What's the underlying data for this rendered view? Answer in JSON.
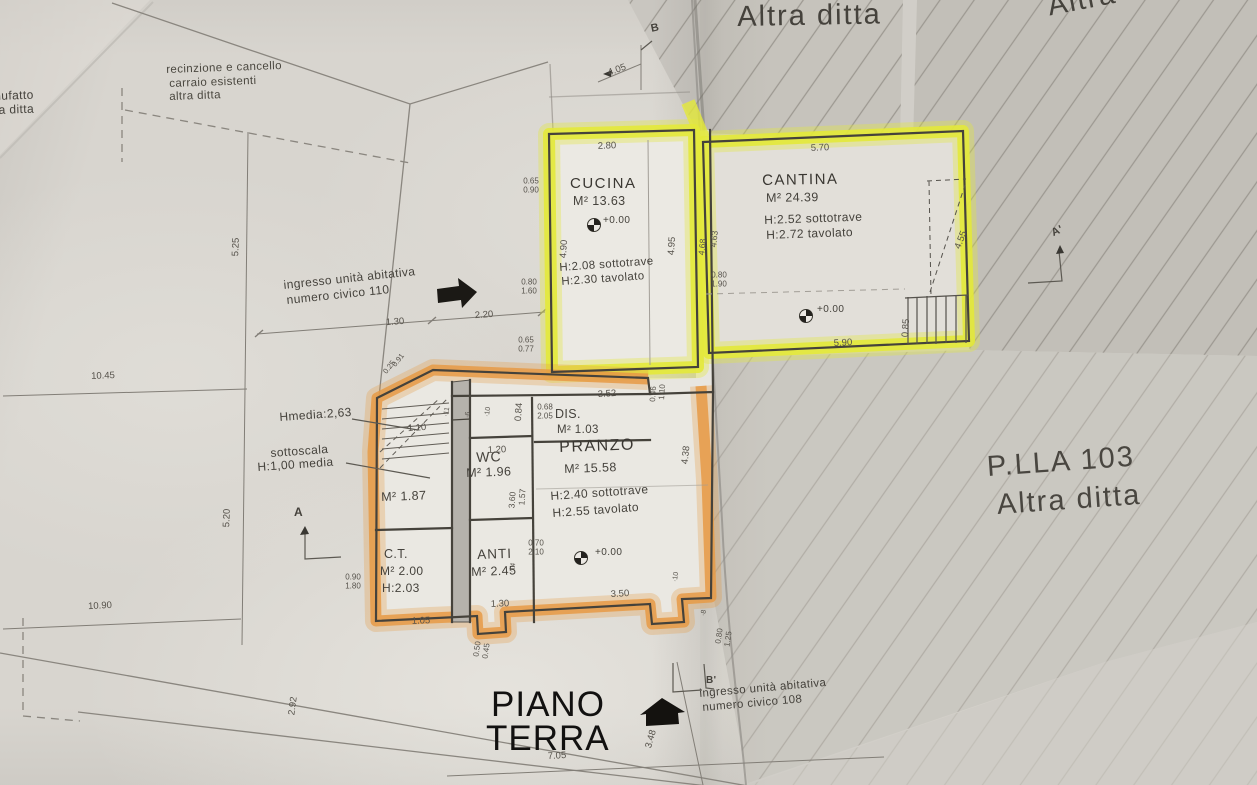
{
  "title": {
    "line1": "PIANO",
    "line2": "TERRA"
  },
  "rooms": {
    "cucina": {
      "name": "CUCINA",
      "area": "M² 13.63",
      "level": "+0.00",
      "h_sottotrave": "H:2.08 sottotrave",
      "h_tavolato": "H:2.30 tavolato"
    },
    "cantina": {
      "name": "CANTINA",
      "area": "M² 24.39",
      "level": "+0.00",
      "h_sottotrave": "H:2.52 sottotrave",
      "h_tavolato": "H:2.72 tavolato"
    },
    "dis": {
      "name": "DIS.",
      "area": "M² 1.03"
    },
    "pranzo": {
      "name": "PRANZO",
      "area": "M² 15.58",
      "level": "+0.00",
      "h_sottotrave": "H:2.40 sottotrave",
      "h_tavolato": "H:2.55 tavolato"
    },
    "wc": {
      "name": "WC",
      "area": "M² 1.96"
    },
    "anti": {
      "name": "ANTI",
      "area": "M² 2.45"
    },
    "ct": {
      "name": "C.T.",
      "area": "M² 2.00",
      "height": "H:2.03"
    },
    "understair": {
      "area": "M² 1.87"
    }
  },
  "annotations": {
    "parcel_top_center": "Altra ditta",
    "parcel_top_right": "Altra ditta",
    "parcel_right": {
      "line1": "P.LLA 103",
      "line2": "Altra ditta"
    },
    "edge_left": {
      "line1": "nufatto",
      "line2": "ra ditta"
    },
    "fence": {
      "line1": "recinzione e cancello",
      "line2": "carraio esistenti",
      "line3": "altra ditta"
    },
    "entrance_110": {
      "line1": "ingresso unità abitativa",
      "line2": "numero civico 110"
    },
    "entrance_108": {
      "line1": "ingresso unità abitativa",
      "line2": "numero civico 108"
    },
    "hmedia": "Hmedia:2,63",
    "sottoscala": {
      "line1": "sottoscala",
      "line2": "H:1,00 media"
    }
  },
  "markers": {
    "a": "A",
    "a_prime": "A'",
    "b": "B",
    "b_prime": "B'"
  },
  "colors": {
    "highlight_yellow": "#e3e93a",
    "highlight_orange": "#e69a45",
    "paper": "#d8d5cf",
    "hatch_fill": "#c7c4be",
    "ink": "#45423b"
  },
  "dimensions": [
    {
      "t": "4.05",
      "x": 617,
      "y": 70,
      "r": -20
    },
    {
      "t": "2.80",
      "x": 607,
      "y": 146,
      "r": -2
    },
    {
      "t": "5.70",
      "x": 820,
      "y": 148,
      "r": -2
    },
    {
      "t": "0.65",
      "x": 531,
      "y": 181,
      "r": 0,
      "s": 8
    },
    {
      "t": "0.90",
      "x": 531,
      "y": 190,
      "r": 0,
      "s": 8
    },
    {
      "t": "4.90",
      "x": 564,
      "y": 249,
      "r": -86
    },
    {
      "t": "4.95",
      "x": 672,
      "y": 246,
      "r": -86
    },
    {
      "t": "4.68",
      "x": 702,
      "y": 247,
      "r": -84,
      "s": 8.5
    },
    {
      "t": "4.63",
      "x": 714,
      "y": 239,
      "r": -84,
      "s": 8.5
    },
    {
      "t": "0.80",
      "x": 719,
      "y": 275,
      "r": 0,
      "s": 8
    },
    {
      "t": "1.90",
      "x": 719,
      "y": 284,
      "r": 0,
      "s": 8
    },
    {
      "t": "0.80",
      "x": 529,
      "y": 282,
      "r": 0,
      "s": 8
    },
    {
      "t": "1.60",
      "x": 529,
      "y": 291,
      "r": 0,
      "s": 8
    },
    {
      "t": "0.65",
      "x": 526,
      "y": 340,
      "r": 0,
      "s": 8
    },
    {
      "t": "0.77",
      "x": 526,
      "y": 349,
      "r": 0,
      "s": 8
    },
    {
      "t": "4.55",
      "x": 961,
      "y": 240,
      "r": -68
    },
    {
      "t": "0.85",
      "x": 906,
      "y": 328,
      "r": -86
    },
    {
      "t": "5.90",
      "x": 843,
      "y": 343,
      "r": -3
    },
    {
      "t": "1.30",
      "x": 395,
      "y": 322,
      "r": -4
    },
    {
      "t": "2.20",
      "x": 484,
      "y": 315,
      "r": -4
    },
    {
      "t": "10.45",
      "x": 103,
      "y": 376,
      "r": -2
    },
    {
      "t": "5.25",
      "x": 236,
      "y": 247,
      "r": -88
    },
    {
      "t": "5.20",
      "x": 227,
      "y": 518,
      "r": -88
    },
    {
      "t": "10.90",
      "x": 100,
      "y": 606,
      "r": -3
    },
    {
      "t": "3.52",
      "x": 607,
      "y": 394,
      "r": -4
    },
    {
      "t": "0.46",
      "x": 653,
      "y": 394,
      "r": -86,
      "s": 8
    },
    {
      "t": "1.10",
      "x": 662,
      "y": 392,
      "r": -86,
      "s": 8
    },
    {
      "t": "0.68",
      "x": 545,
      "y": 407,
      "r": 0,
      "s": 8
    },
    {
      "t": "2.05",
      "x": 545,
      "y": 416,
      "r": 0,
      "s": 8
    },
    {
      "t": "0.84",
      "x": 519,
      "y": 412,
      "r": -86
    },
    {
      "t": "1.10",
      "x": 417,
      "y": 428,
      "r": -4
    },
    {
      "t": "1.20",
      "x": 497,
      "y": 450,
      "r": -2
    },
    {
      "t": "·11",
      "x": 447,
      "y": 412,
      "r": -80,
      "s": 7
    },
    {
      "t": "·6",
      "x": 468,
      "y": 415,
      "r": -80,
      "s": 7
    },
    {
      "t": "·10",
      "x": 488,
      "y": 412,
      "r": -80,
      "s": 7
    },
    {
      "t": "4.38",
      "x": 686,
      "y": 455,
      "r": -84
    },
    {
      "t": "3.60",
      "x": 512,
      "y": 500,
      "r": -86,
      "s": 8.5
    },
    {
      "t": "1.57",
      "x": 522,
      "y": 497,
      "r": -86,
      "s": 8.5
    },
    {
      "t": "0.70",
      "x": 536,
      "y": 543,
      "r": 0,
      "s": 8
    },
    {
      "t": "2.10",
      "x": 536,
      "y": 552,
      "r": 0,
      "s": 8
    },
    {
      "t": "·14",
      "x": 513,
      "y": 568,
      "r": -80,
      "s": 7
    },
    {
      "t": "·10",
      "x": 676,
      "y": 577,
      "r": -80,
      "s": 7
    },
    {
      "t": "3.50",
      "x": 620,
      "y": 594,
      "r": -3
    },
    {
      "t": "1.30",
      "x": 500,
      "y": 604,
      "r": -2
    },
    {
      "t": "1.05",
      "x": 421,
      "y": 621,
      "r": -2
    },
    {
      "t": "0.90",
      "x": 353,
      "y": 577,
      "r": 0,
      "s": 8
    },
    {
      "t": "1.80",
      "x": 353,
      "y": 586,
      "r": 0,
      "s": 8
    },
    {
      "t": "0.50",
      "x": 477,
      "y": 649,
      "r": -82,
      "s": 8
    },
    {
      "t": "0.45",
      "x": 486,
      "y": 651,
      "r": -82,
      "s": 8
    },
    {
      "t": "·8",
      "x": 704,
      "y": 613,
      "r": -80,
      "s": 7
    },
    {
      "t": "0.80",
      "x": 719,
      "y": 636,
      "r": -82,
      "s": 8
    },
    {
      "t": "1.25",
      "x": 728,
      "y": 639,
      "r": -82,
      "s": 8
    },
    {
      "t": "7.05",
      "x": 557,
      "y": 756,
      "r": -3
    },
    {
      "t": "3.48",
      "x": 651,
      "y": 739,
      "r": -74
    },
    {
      "t": "2.92",
      "x": 293,
      "y": 706,
      "r": -82
    },
    {
      "t": "0.25",
      "x": 389,
      "y": 367,
      "r": -52,
      "s": 7.5
    },
    {
      "t": "0.91",
      "x": 398,
      "y": 360,
      "r": -52,
      "s": 7.5
    }
  ]
}
